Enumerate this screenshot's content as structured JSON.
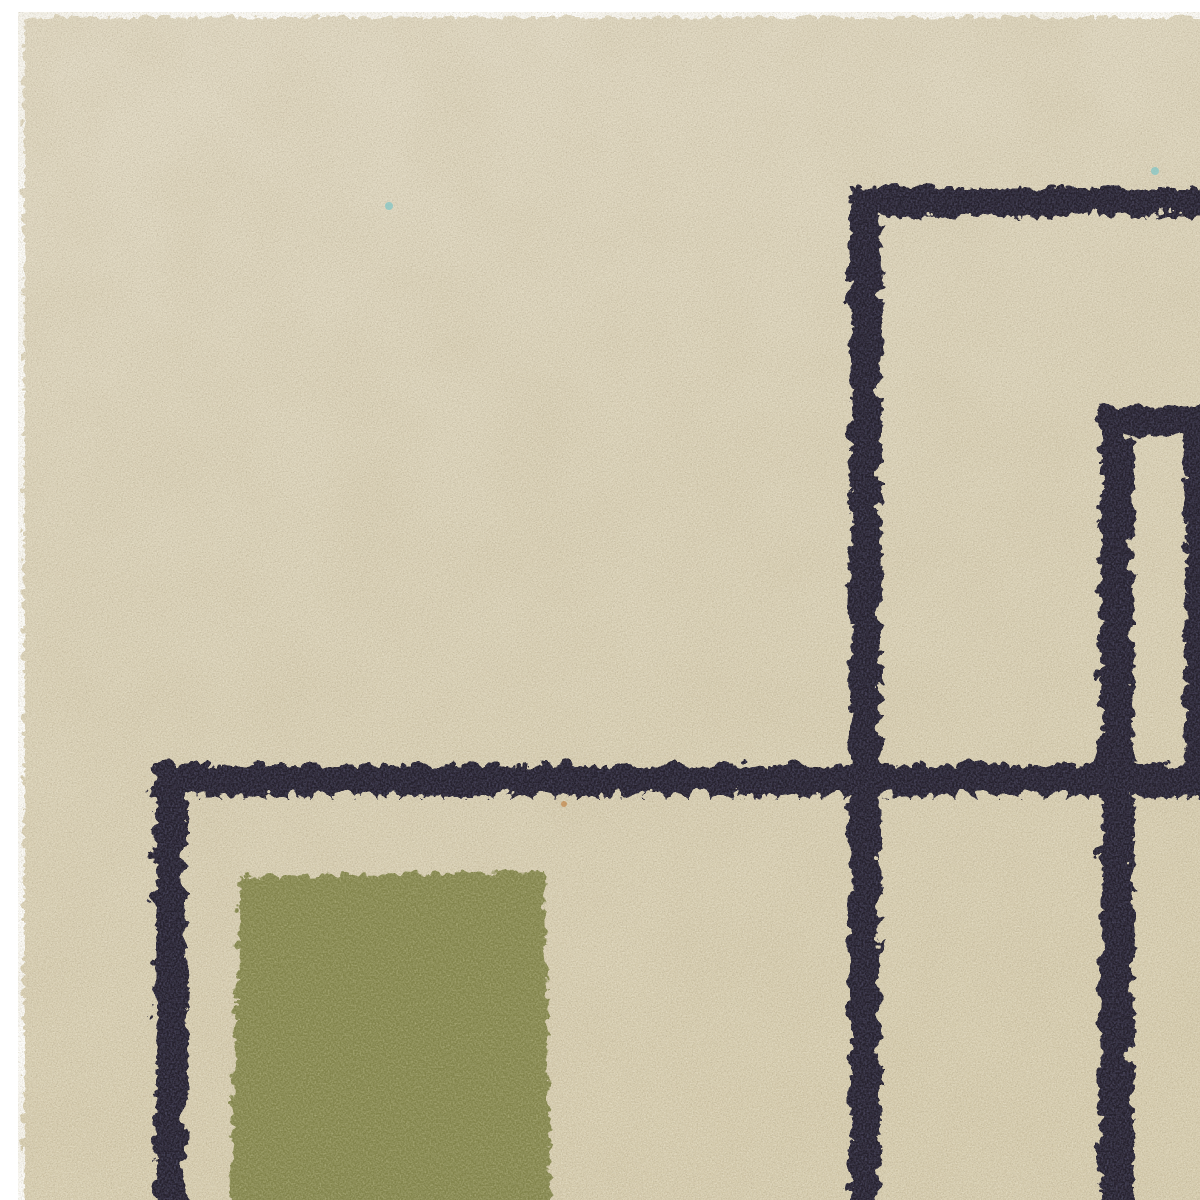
{
  "photo": {
    "alt": "Close-up corner detail of a cream hand-tufted wool rug with a dark navy geometric line pattern and an olive green rectangular block, product photo on a plain white background",
    "texture": "dense cut wool pile"
  },
  "colors": {
    "page_background": "#ffffff",
    "pile_base_top": "#ded6c1",
    "pile_base_mid": "#d8cfb5",
    "pile_base_bottom": "#d5cbad",
    "pile_mottle": "#c9bd9d",
    "pile_speckle_light": "#f3eedb",
    "pile_speckle_dark": "#8d8167",
    "pattern_navy": "#27242f",
    "pattern_navy_fiber": "#4b4860",
    "block_olive": "#82844c",
    "block_olive_fiber": "#a6a773",
    "fleck_teal": "#7cc4c6",
    "fleck_orange": "#c08040"
  }
}
